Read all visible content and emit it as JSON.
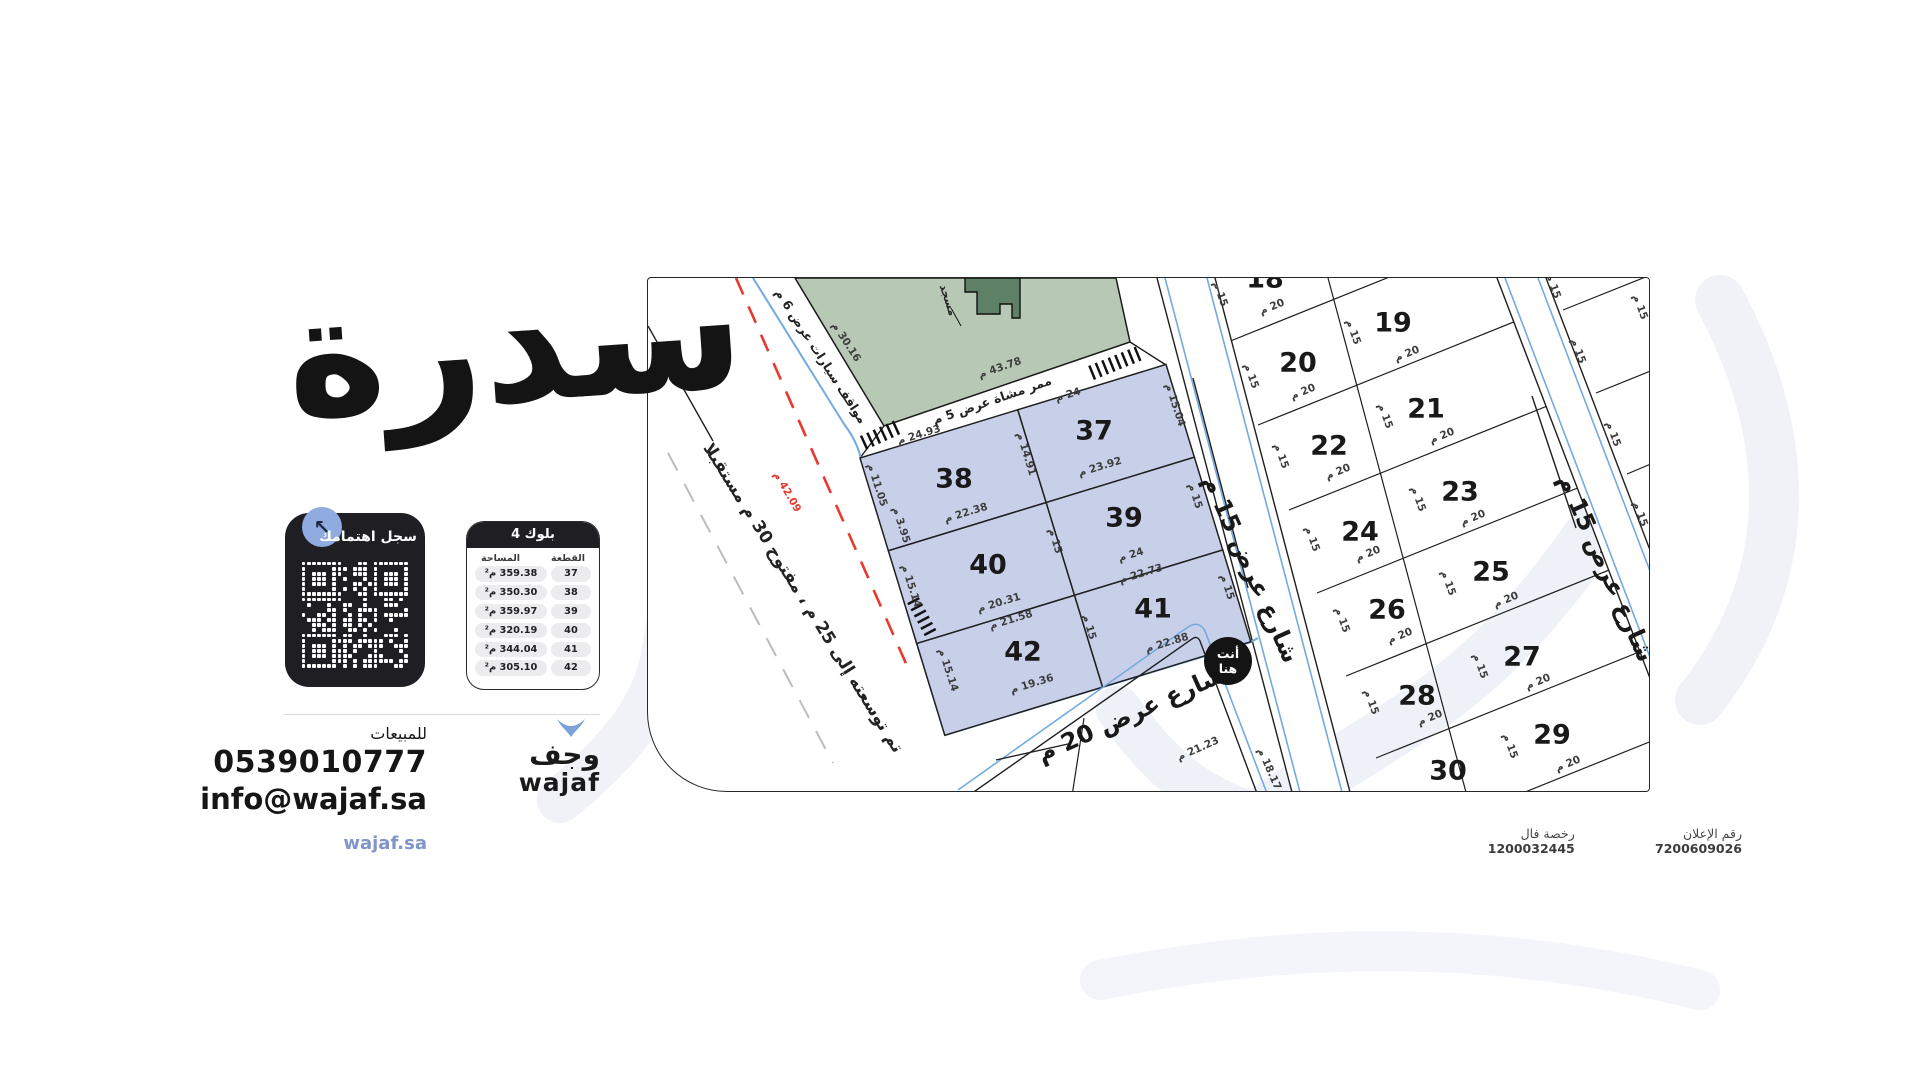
{
  "brand": {
    "calligraphy": "سدرة",
    "logo_ar": "وجف",
    "logo_en": "wajaf",
    "site": "wajaf.sa"
  },
  "qr": {
    "title": "سجل اهتمامك"
  },
  "table": {
    "title": "بلوك 4",
    "col_area": "المساحة",
    "col_plot": "القطعة",
    "rows": [
      {
        "plot": "37",
        "area": "359.38 م²"
      },
      {
        "plot": "38",
        "area": "350.30 م²"
      },
      {
        "plot": "39",
        "area": "359.97 م²"
      },
      {
        "plot": "40",
        "area": "320.19 م²"
      },
      {
        "plot": "41",
        "area": "344.04 م²"
      },
      {
        "plot": "42",
        "area": "305.10 م²"
      }
    ]
  },
  "contact": {
    "label": "للمبيعات",
    "phone": "0539010777",
    "email": "info@wajaf.sa"
  },
  "footer": {
    "ad_label": "رقم الإعلان",
    "ad_number": "7200609026",
    "license_label": "رخصة فال",
    "license_number": "1200032445"
  },
  "map": {
    "you_here_1": "أنت",
    "you_here_2": "هنا",
    "labels": [
      {
        "t": "شارع عرض 15 م",
        "x": 603,
        "y": 291,
        "r": 66,
        "cls": "street"
      },
      {
        "t": "شارع عرض 15 م",
        "x": 958,
        "y": 290,
        "r": 66,
        "cls": "street"
      },
      {
        "t": "شارع عرض 20 م",
        "x": 483,
        "y": 436,
        "r": -24,
        "cls": "street"
      },
      {
        "t": "تم توسعته إلى 25 م ، مفتوح 30 م مستقبلا",
        "x": 155,
        "y": 320,
        "r": 58,
        "cls": "note"
      },
      {
        "t": "مواقف سيارات عرض 6 م",
        "x": 173,
        "y": 78,
        "r": 57,
        "cls": "subnote"
      },
      {
        "t": "ممر مشاة عرض 5 م",
        "x": 344,
        "y": 122,
        "r": -19,
        "cls": "subnote"
      },
      {
        "t": "مسجد",
        "x": 300,
        "y": 22,
        "r": 72,
        "cls": "mosque"
      },
      {
        "t": "42.09 م",
        "x": 139,
        "y": 214,
        "r": 60,
        "cls": "dim red"
      },
      {
        "t": "30.16 م",
        "x": 198,
        "y": 64,
        "r": 57,
        "cls": "dim"
      },
      {
        "t": "43.78 م",
        "x": 352,
        "y": 90,
        "r": -19,
        "cls": "dim"
      },
      {
        "t": "37",
        "x": 446,
        "y": 153,
        "r": 0,
        "cls": "pnum"
      },
      {
        "t": "38",
        "x": 306,
        "y": 201,
        "r": 0,
        "cls": "pnum"
      },
      {
        "t": "39",
        "x": 476,
        "y": 240,
        "r": 0,
        "cls": "pnum"
      },
      {
        "t": "40",
        "x": 340,
        "y": 287,
        "r": 0,
        "cls": "pnum"
      },
      {
        "t": "41",
        "x": 505,
        "y": 331,
        "r": 0,
        "cls": "pnum"
      },
      {
        "t": "42",
        "x": 375,
        "y": 374,
        "r": 0,
        "cls": "pnum"
      },
      {
        "t": "24 م",
        "x": 420,
        "y": 117,
        "r": -17,
        "cls": "dim"
      },
      {
        "t": "15.04 م",
        "x": 527,
        "y": 127,
        "r": 72,
        "cls": "dim"
      },
      {
        "t": "24.93 م",
        "x": 271,
        "y": 157,
        "r": -17,
        "cls": "dim"
      },
      {
        "t": "14.91 م",
        "x": 378,
        "y": 176,
        "r": 73,
        "cls": "dim"
      },
      {
        "t": "11.05 م",
        "x": 229,
        "y": 207,
        "r": 72,
        "cls": "dim"
      },
      {
        "t": "3.95 م",
        "x": 253,
        "y": 247,
        "r": 72,
        "cls": "dim"
      },
      {
        "t": "22.38 م",
        "x": 318,
        "y": 235,
        "r": -17,
        "cls": "dim"
      },
      {
        "t": "23.92 م",
        "x": 452,
        "y": 189,
        "r": -17,
        "cls": "dim"
      },
      {
        "t": "15 م",
        "x": 407,
        "y": 263,
        "r": 73,
        "cls": "dim"
      },
      {
        "t": "15 م",
        "x": 547,
        "y": 218,
        "r": 72,
        "cls": "dim"
      },
      {
        "t": "24 م",
        "x": 483,
        "y": 277,
        "r": -17,
        "cls": "dim"
      },
      {
        "t": "22.73 م",
        "x": 493,
        "y": 296,
        "r": -17,
        "cls": "dim"
      },
      {
        "t": "20.31 م",
        "x": 351,
        "y": 325,
        "r": -17,
        "cls": "dim"
      },
      {
        "t": "21.58 م",
        "x": 363,
        "y": 342,
        "r": -17,
        "cls": "dim"
      },
      {
        "t": "15.14 م",
        "x": 263,
        "y": 308,
        "r": 72,
        "cls": "dim"
      },
      {
        "t": "15.14 م",
        "x": 300,
        "y": 392,
        "r": 72,
        "cls": "dim"
      },
      {
        "t": "15 م",
        "x": 441,
        "y": 349,
        "r": 73,
        "cls": "dim"
      },
      {
        "t": "15 م",
        "x": 579,
        "y": 309,
        "r": 72,
        "cls": "dim"
      },
      {
        "t": "22.88 م",
        "x": 519,
        "y": 365,
        "r": -17,
        "cls": "dim"
      },
      {
        "t": "19.36 م",
        "x": 384,
        "y": 406,
        "r": -17,
        "cls": "dim"
      },
      {
        "t": "18",
        "x": 617,
        "y": 1,
        "r": 0,
        "cls": "pnum"
      },
      {
        "t": "19",
        "x": 745,
        "y": 45,
        "r": 0,
        "cls": "pnum"
      },
      {
        "t": "20",
        "x": 650,
        "y": 85,
        "r": 0,
        "cls": "pnum"
      },
      {
        "t": "21",
        "x": 778,
        "y": 131,
        "r": 0,
        "cls": "pnum"
      },
      {
        "t": "22",
        "x": 681,
        "y": 168,
        "r": 0,
        "cls": "pnum"
      },
      {
        "t": "23",
        "x": 812,
        "y": 214,
        "r": 0,
        "cls": "pnum"
      },
      {
        "t": "24",
        "x": 712,
        "y": 254,
        "r": 0,
        "cls": "pnum"
      },
      {
        "t": "25",
        "x": 843,
        "y": 294,
        "r": 0,
        "cls": "pnum"
      },
      {
        "t": "26",
        "x": 739,
        "y": 332,
        "r": 0,
        "cls": "pnum"
      },
      {
        "t": "27",
        "x": 874,
        "y": 379,
        "r": 0,
        "cls": "pnum"
      },
      {
        "t": "28",
        "x": 769,
        "y": 418,
        "r": 0,
        "cls": "pnum"
      },
      {
        "t": "29",
        "x": 904,
        "y": 457,
        "r": 0,
        "cls": "pnum"
      },
      {
        "t": "30",
        "x": 800,
        "y": 493,
        "r": 0,
        "cls": "pnum"
      },
      {
        "t": "15 م",
        "x": 572,
        "y": 16,
        "r": 70,
        "cls": "dim"
      },
      {
        "t": "15 م",
        "x": 603,
        "y": 98,
        "r": 70,
        "cls": "dim"
      },
      {
        "t": "15 م",
        "x": 633,
        "y": 178,
        "r": 70,
        "cls": "dim"
      },
      {
        "t": "15 م",
        "x": 664,
        "y": 261,
        "r": 70,
        "cls": "dim"
      },
      {
        "t": "15 م",
        "x": 694,
        "y": 342,
        "r": 70,
        "cls": "dim"
      },
      {
        "t": "15 م",
        "x": 723,
        "y": 424,
        "r": 70,
        "cls": "dim"
      },
      {
        "t": "15 م",
        "x": 705,
        "y": 54,
        "r": 70,
        "cls": "dim"
      },
      {
        "t": "15 م",
        "x": 737,
        "y": 138,
        "r": 70,
        "cls": "dim"
      },
      {
        "t": "15 م",
        "x": 770,
        "y": 221,
        "r": 70,
        "cls": "dim"
      },
      {
        "t": "15 م",
        "x": 800,
        "y": 305,
        "r": 70,
        "cls": "dim"
      },
      {
        "t": "15 م",
        "x": 832,
        "y": 388,
        "r": 70,
        "cls": "dim"
      },
      {
        "t": "15 م",
        "x": 862,
        "y": 468,
        "r": 70,
        "cls": "dim"
      },
      {
        "t": "15 م",
        "x": 905,
        "y": 8,
        "r": 70,
        "cls": "dim"
      },
      {
        "t": "15 م",
        "x": 930,
        "y": 73,
        "r": 70,
        "cls": "dim"
      },
      {
        "t": "15 م",
        "x": 965,
        "y": 156,
        "r": 70,
        "cls": "dim"
      },
      {
        "t": "15 م",
        "x": 992,
        "y": 236,
        "r": 70,
        "cls": "dim"
      },
      {
        "t": "15 م",
        "x": 992,
        "y": 29,
        "r": 70,
        "cls": "dim"
      },
      {
        "t": "20 م",
        "x": 624,
        "y": 29,
        "r": -22,
        "cls": "dim"
      },
      {
        "t": "20 م",
        "x": 655,
        "y": 114,
        "r": -22,
        "cls": "dim"
      },
      {
        "t": "20 م",
        "x": 690,
        "y": 194,
        "r": -22,
        "cls": "dim"
      },
      {
        "t": "20 م",
        "x": 720,
        "y": 276,
        "r": -22,
        "cls": "dim"
      },
      {
        "t": "20 م",
        "x": 752,
        "y": 358,
        "r": -22,
        "cls": "dim"
      },
      {
        "t": "20 م",
        "x": 782,
        "y": 440,
        "r": -22,
        "cls": "dim"
      },
      {
        "t": "20 م",
        "x": 759,
        "y": 76,
        "r": -22,
        "cls": "dim"
      },
      {
        "t": "20 م",
        "x": 794,
        "y": 158,
        "r": -22,
        "cls": "dim"
      },
      {
        "t": "20 م",
        "x": 825,
        "y": 240,
        "r": -22,
        "cls": "dim"
      },
      {
        "t": "20 م",
        "x": 858,
        "y": 322,
        "r": -22,
        "cls": "dim"
      },
      {
        "t": "20 م",
        "x": 890,
        "y": 404,
        "r": -22,
        "cls": "dim"
      },
      {
        "t": "20 م",
        "x": 920,
        "y": 486,
        "r": -22,
        "cls": "dim"
      },
      {
        "t": "21.23 م",
        "x": 550,
        "y": 471,
        "r": -24,
        "cls": "dim"
      },
      {
        "t": "18.17 م",
        "x": 621,
        "y": 491,
        "r": 66,
        "cls": "dim"
      }
    ]
  }
}
